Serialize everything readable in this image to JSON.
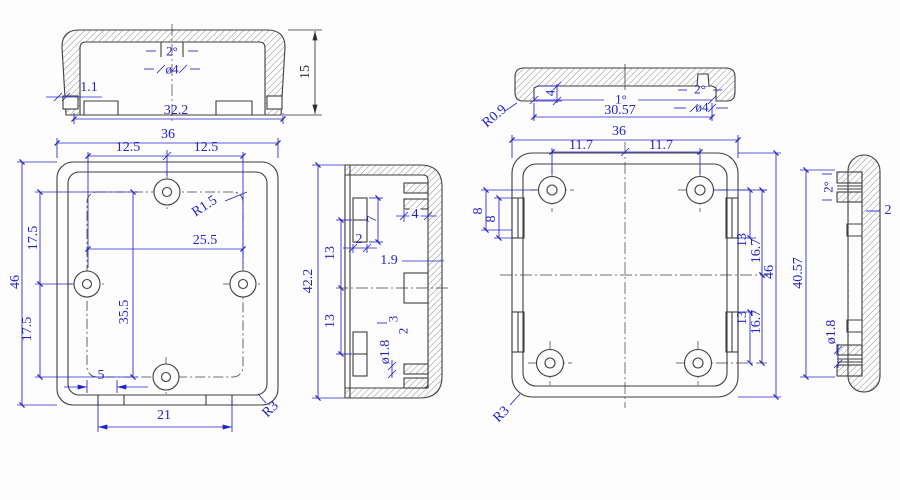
{
  "drawing": {
    "type": "engineering-drawing",
    "colors": {
      "dimension_blue": "#2323cb",
      "outline_gray": "#3f3f3f"
    }
  },
  "views": {
    "lid_front_section": {
      "draft_angle": "2°",
      "boss_dia": "ø4",
      "rib_width": "1.1",
      "overall_width": "32.2",
      "overall_height": "15"
    },
    "base_outside": {
      "overall_width": "36",
      "hole_left": "12.5",
      "hole_right": "12.5",
      "corner_fillet": "R1.5",
      "hole_span": "25.5",
      "hole_upper": "17.5",
      "hole_lower": "17.5",
      "overall_height": "46",
      "hole_vspan": "35.5",
      "slot_width": "5",
      "slot_span": "21",
      "corner_radius": "R3"
    },
    "base_side_section": {
      "overall_height": "42.2",
      "clip_upper": "13",
      "clip_lower": "13",
      "clip_width": "2",
      "clip_height": "7",
      "boss_depth": "4",
      "wall_thickness": "1.9",
      "boss_height": "3",
      "boss_gap": "2",
      "hole_dia": "ø1.8"
    },
    "lid_top_section": {
      "rim_radius": "R0.9",
      "lip_height": "4",
      "draft_angle": "1°",
      "inner_width": "30.57",
      "boss_draft": "2°",
      "boss_dia": "ø4"
    },
    "base_inside": {
      "overall_width": "36",
      "hole_left": "11.7",
      "hole_right": "11.7",
      "clip_dim_a": "8",
      "clip_dim_b": "8",
      "clip_top": "13",
      "boss_top": "16.7",
      "overall_height": "46",
      "clip_bottom": "13",
      "boss_bottom": "16.7",
      "corner_radius": "R3"
    },
    "lid_side_section": {
      "draft_angle": "2°",
      "wall_thickness": "2",
      "inner_height": "40.57",
      "hole_dia": "ø1.8"
    }
  }
}
